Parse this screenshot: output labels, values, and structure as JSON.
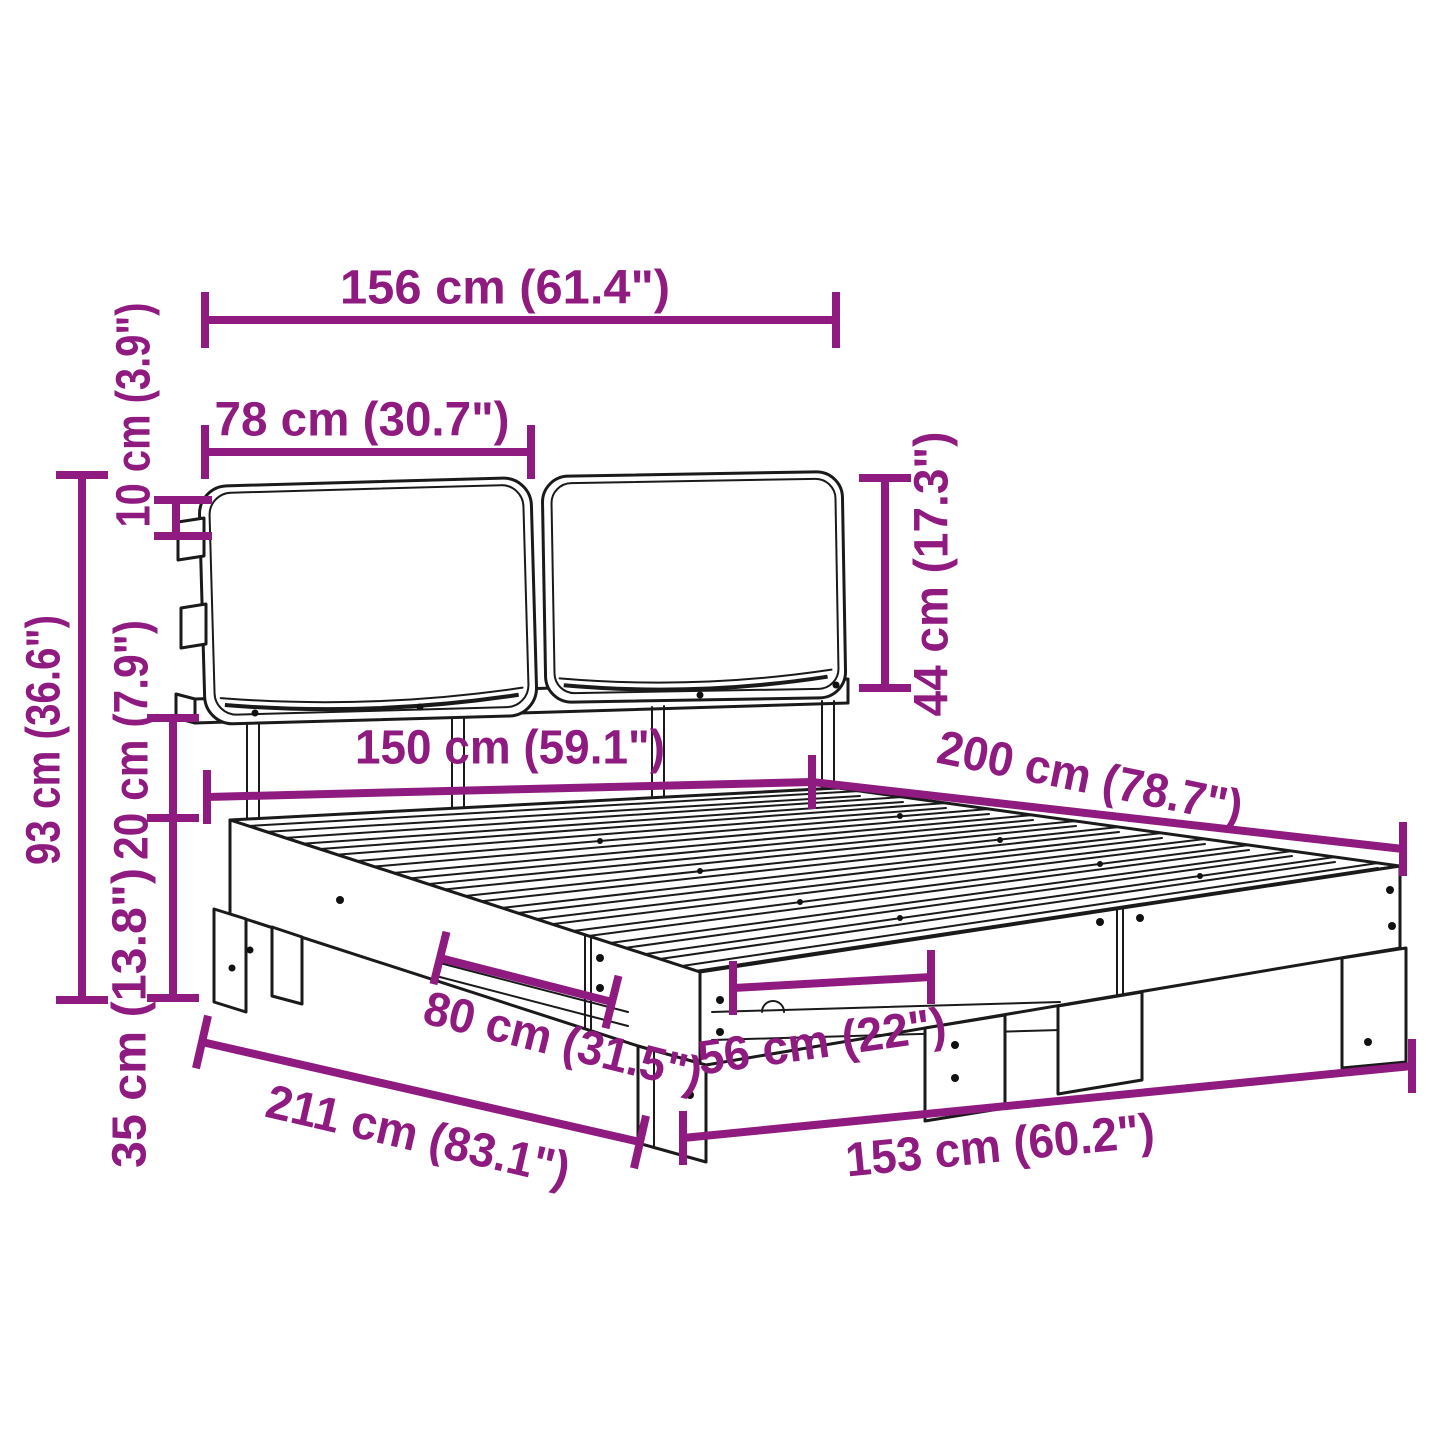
{
  "diagram": {
    "type": "furniture-dimension-diagram",
    "subject": "bed frame with slatted base and two headboard cushions",
    "colors": {
      "dimension_accent": "#8F1A80",
      "line_art": "#1A1A1A",
      "background": "#FFFFFF"
    },
    "dimensions": [
      {
        "id": "headboard-total-width",
        "label": "156 cm (61.4\")",
        "cm": "156",
        "inches": "61.4",
        "orientation": "horizontal"
      },
      {
        "id": "cushion-width",
        "label": "78 cm (30.7\")",
        "cm": "78",
        "inches": "30.7",
        "orientation": "horizontal"
      },
      {
        "id": "cushion-thickness",
        "label": "10 cm (3.9\")",
        "cm": "10",
        "inches": "3.9",
        "orientation": "vertical"
      },
      {
        "id": "headboard-height",
        "label": "93 cm (36.6\")",
        "cm": "93",
        "inches": "36.6",
        "orientation": "vertical"
      },
      {
        "id": "frame-rail-height",
        "label": "20 cm (7.9\")",
        "cm": "20",
        "inches": "7.9",
        "orientation": "vertical"
      },
      {
        "id": "under-bed-clearance",
        "label": "35 cm (13.8\")",
        "cm": "35",
        "inches": "13.8",
        "orientation": "vertical"
      },
      {
        "id": "cushion-height",
        "label": "44 cm (17.3\")",
        "cm": "44",
        "inches": "17.3",
        "orientation": "vertical"
      },
      {
        "id": "mattress-width",
        "label": "150 cm (59.1\")",
        "cm": "150",
        "inches": "59.1",
        "orientation": "horizontal"
      },
      {
        "id": "mattress-length",
        "label": "200 cm (78.7\")",
        "cm": "200",
        "inches": "78.7",
        "orientation": "diagonal"
      },
      {
        "id": "side-leg-spacing",
        "label": "80 cm (31.5\")",
        "cm": "80",
        "inches": "31.5",
        "orientation": "diagonal"
      },
      {
        "id": "foot-leg-spacing",
        "label": "56 cm (22\")",
        "cm": "56",
        "inches": "22",
        "orientation": "horizontal"
      },
      {
        "id": "total-length",
        "label": "211 cm (83.1\")",
        "cm": "211",
        "inches": "83.1",
        "orientation": "diagonal"
      },
      {
        "id": "total-width",
        "label": "153 cm (60.2\")",
        "cm": "153",
        "inches": "60.2",
        "orientation": "horizontal"
      }
    ]
  }
}
